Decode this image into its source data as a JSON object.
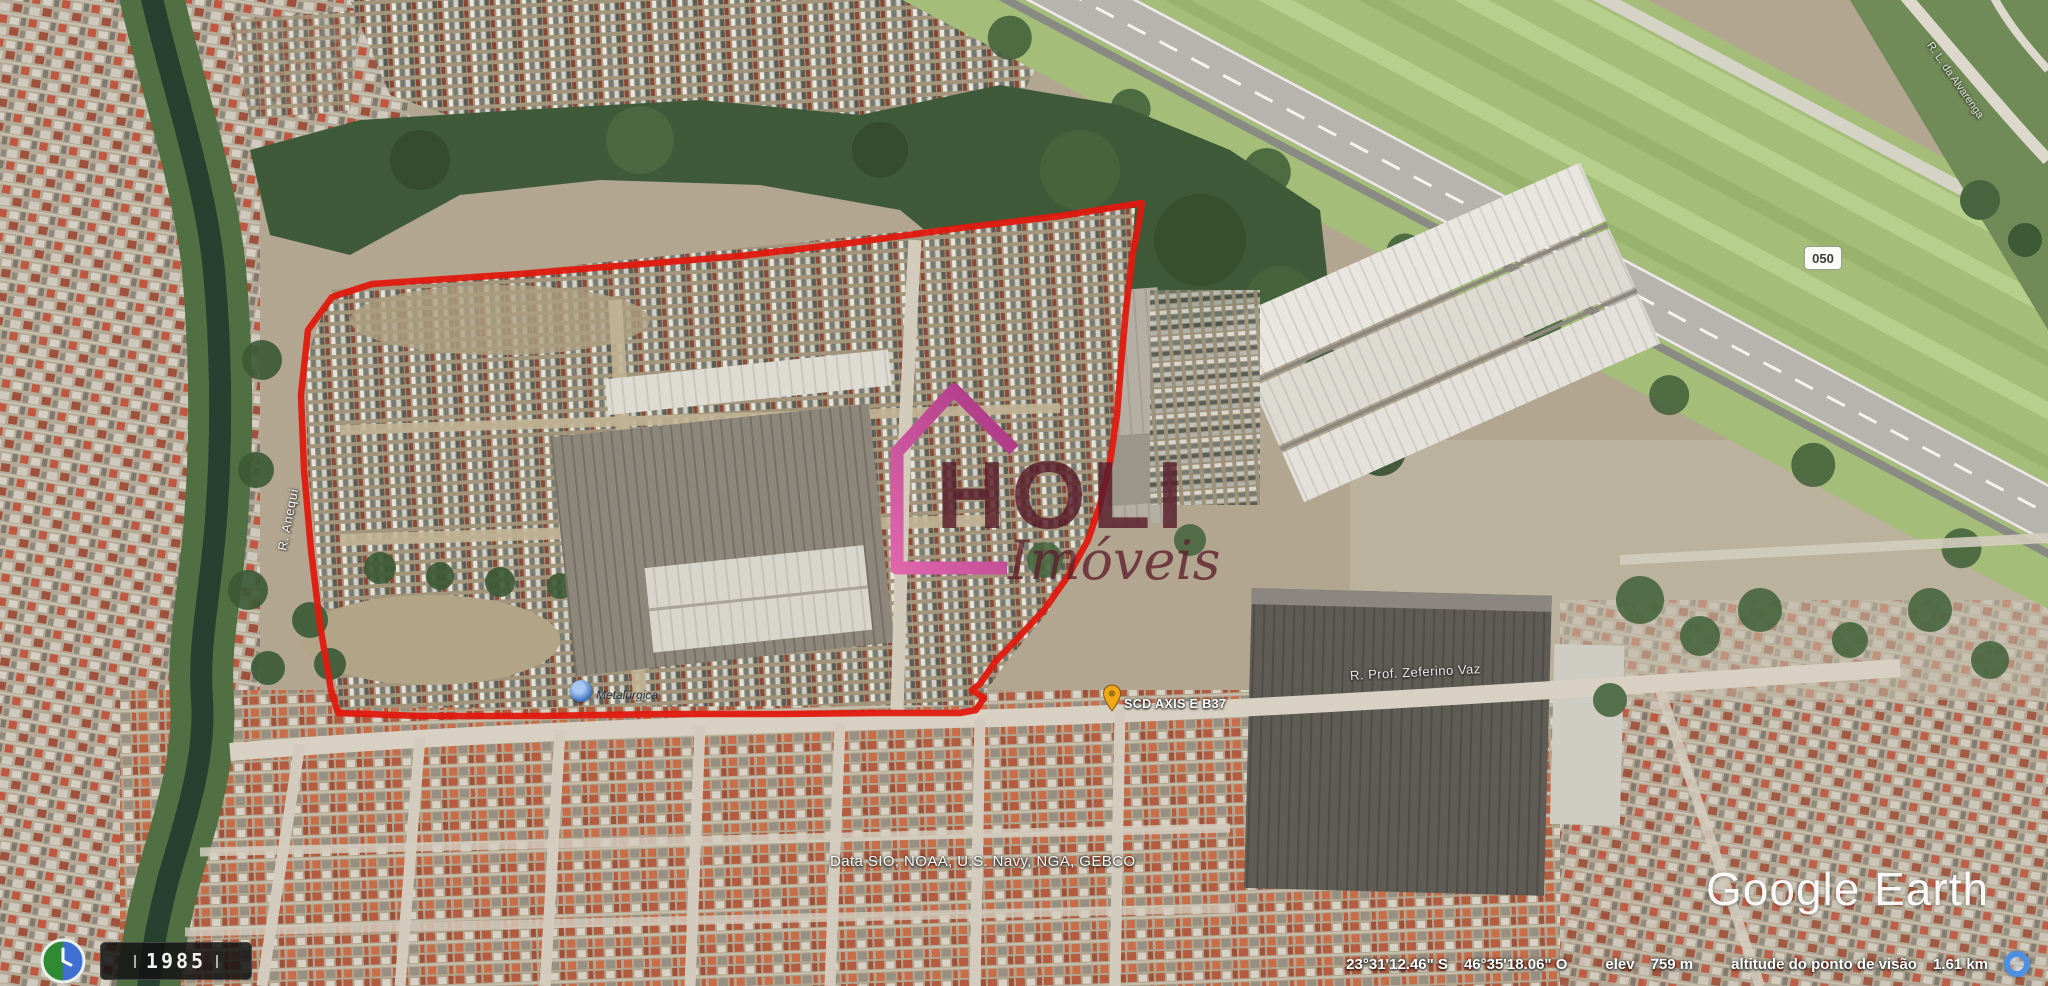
{
  "app": "Google Earth",
  "colors": {
    "boundary": "#e8170d",
    "logo_house_pink": "#c2448f",
    "logo_text_maroon": "#5c1f2c",
    "canal_water": "#27402f",
    "grass_strip": "#a3bd77"
  },
  "watermark": {
    "text": "Google Earth"
  },
  "attribution": {
    "text": "Data SIO, NOAA, U.S. Navy, NGA, GEBCO"
  },
  "status_bar": {
    "latitude": "23°31'12.46\" S",
    "longitude": "46°35'18.06\" O",
    "elevation_label": "elev",
    "elevation_value": "759 m",
    "eye_altitude_label": "altitude do ponto de visão",
    "eye_altitude_value": "1.61 km"
  },
  "time_slider": {
    "year": "1985"
  },
  "map_labels": {
    "street_left_vertical": "R. Anequi",
    "street_right": "R. Prof. Zeferino Vaz",
    "street_top_right": "R. L. da Alvarenga",
    "poi_blue_label": "Metalúrgica",
    "poi_pin_label": "SCD AXIS E B37",
    "road_badge": "050"
  },
  "overlay_logo": {
    "title": "HOLI",
    "subtitle": "Imóveis"
  }
}
